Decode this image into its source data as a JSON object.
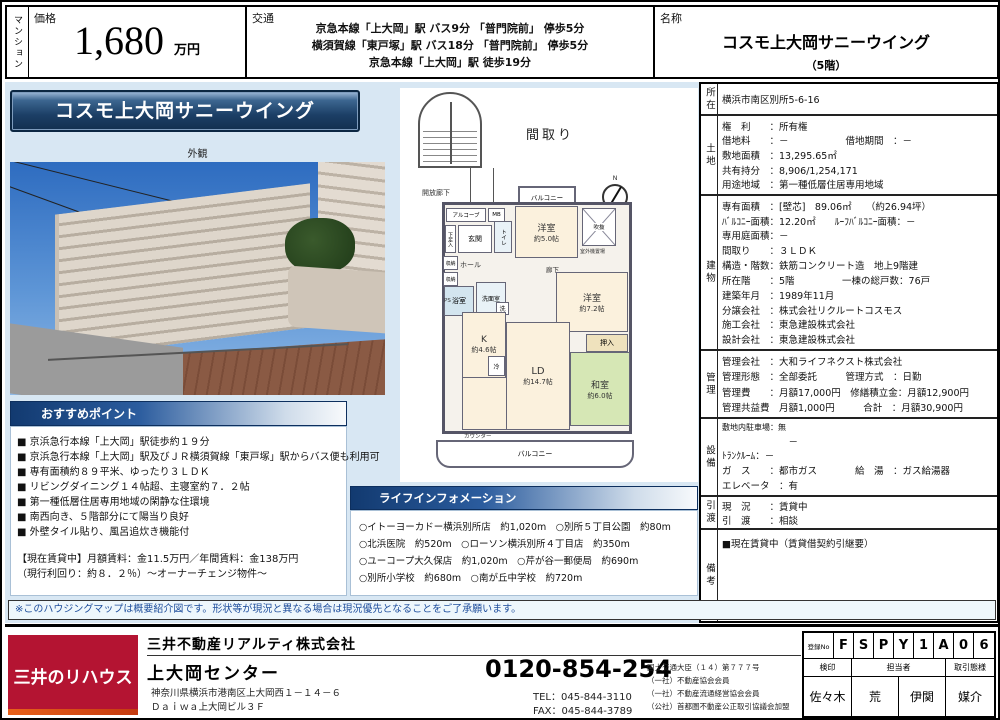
{
  "colors": {
    "accent_navy": "#16386b",
    "brand_red": "#b41432",
    "page_bg": "#d8e7f3"
  },
  "header": {
    "category": "マンション",
    "price_label": "価格",
    "price_value": "1,680",
    "price_unit": "万円",
    "access_label": "交通",
    "access_lines": [
      "京急本線「上大岡」駅 バス9分 「普門院前」 停歩5分",
      "横須賀線「東戸塚」駅 バス18分 「普門院前」 停歩5分",
      "京急本線「上大岡」駅 徒歩19分"
    ],
    "name_label": "名称",
    "name_value": "コスモ上大岡サニーウイング",
    "name_floor": "（5階）"
  },
  "left": {
    "banner": "コスモ上大岡サニーウイング",
    "photo_caption": "外観",
    "recommend": {
      "title": "おすすめポイント",
      "items": [
        "■ 京浜急行本線「上大岡」駅徒歩約１９分",
        "■ 京浜急行本線「上大岡」駅及びＪＲ横須賀線「東戸塚」駅からバス便も利用可",
        "■ 専有面積約８９平米、ゆったり３ＬＤＫ",
        "■ リビングダイニング１４帖超、主寝室約７．２帖",
        "■ 第一種低層住居専用地域の閑静な住環境",
        "■ 南西向き、５階部分にて陽当り良好",
        "■ 外壁タイル貼り、風呂追炊き機能付"
      ],
      "notes": [
        "【現在賃貸中】月額賃料：金11.5万円／年間賃料：金138万円",
        "（現行利回り：約８．２％）～オーナーチェンジ物件～"
      ]
    }
  },
  "floorplan": {
    "title": "間取り",
    "compass_n": "N",
    "labels": {
      "open_corridor": "開放廊下",
      "alcove": "アルコーブ",
      "mb": "MB",
      "entrance": "玄関",
      "shoe_box": "下足入",
      "storage": "収納",
      "hall": "ホール",
      "toilet": "トイレ",
      "bath": "浴室",
      "washroom": "洗面室",
      "laundry": "洗",
      "ps": "PS",
      "corridor": "廊下",
      "balcony": "バルコニー",
      "western1_name": "洋室",
      "western1_size": "約5.0帖",
      "void": "吹抜",
      "outdoor_unit": "室外機置場",
      "western2_name": "洋室",
      "western2_size": "約7.2帖",
      "closet": "押入",
      "kitchen_name": "K",
      "kitchen_size": "約4.6帖",
      "fridge": "冷",
      "ld_name": "LD",
      "ld_size": "約14.7帖",
      "japanese_name": "和室",
      "japanese_size": "約6.0帖",
      "counter": "カウンター"
    }
  },
  "life_info": {
    "title": "ライフインフォメーション",
    "lines": [
      "○イトーヨーカドー横浜別所店　約1,020m　○別所５丁目公園　約80m",
      "○北浜医院　約520m　○ローソン横浜別所４丁目店　約350m",
      "○ユーコープ大久保店　約1,020m　○芹が谷一郵便局　約690m",
      "○別所小学校　約680m　○南が丘中学校　約720m"
    ]
  },
  "details": {
    "location": {
      "label": "所在",
      "value": "横浜市南区別所5-6-16"
    },
    "land": {
      "label": "土地",
      "lines": [
        "権　利　　：所有権",
        "借地料　　：－　　　　　　借地期間　：－",
        "敷地面積　：13,295.65㎡",
        "共有持分　：8,906/1,254,171",
        "用途地域　：第一種低層住居専用地域"
      ]
    },
    "building": {
      "label": "建物",
      "lines": [
        "専有面積　：[壁芯]　89.06㎡　　（約26.94坪）",
        "ﾊﾞﾙｺﾆｰ面積：12.20㎡　　ﾙｰﾌﾊﾞﾙｺﾆｰ面積：－",
        "専用庭面積：－",
        "間取り　　：３ＬＤＫ",
        "構造・階数：鉄筋コンクリート造　地上9階建",
        "所在階　　：5階　　　　　一棟の総戸数：76戸",
        "建築年月　：1989年11月",
        "分譲会社　：株式会社リクルートコスモス",
        "施工会社　：東急建設株式会社",
        "設計会社　：東急建設株式会社"
      ]
    },
    "management": {
      "label": "管理",
      "lines": [
        "管理会社　：大和ライフネクスト株式会社",
        "管理形態　：全部委託　　　管理方式　：日勤",
        "管理費　　：月額17,000円　修繕積立金：月額12,900円",
        "管理共益費　月額1,000円　　　合計　：月額30,900円"
      ]
    },
    "facility": {
      "label": "設備",
      "lines": [
        "敷地内駐車場：無",
        "　　　　　　　－",
        "ﾄﾗﾝｸﾙｰﾑ：－",
        "ガ　ス　　：都市ガス　　　　給　湯　：ガス給湯器",
        "エレベータ　：有"
      ]
    },
    "delivery": {
      "label": "引渡",
      "lines": [
        "現　況　　：賃貸中",
        "引　渡　　：相談"
      ]
    },
    "remarks": {
      "label": "備考",
      "lines": [
        "■現在賃貸中（賃貸借契約引継要）"
      ]
    }
  },
  "disclaimer": "※このハウジングマップは概要紹介図です。形状等が現況と異なる場合は現況優先となることをご了承願います。",
  "footer": {
    "logo": "三井のリハウス",
    "company": "三井不動産リアルティ株式会社",
    "branch": "上大岡センター",
    "address1": "神奈川県横浜市港南区上大岡西１－１４－６",
    "address2": "Ｄａｉｗａ上大岡ビル３Ｆ",
    "freedial": "0120-854-254",
    "tel": "TEL：045-844-3110",
    "fax": "FAX：045-844-3789",
    "license_lines": [
      "国土交通大臣（１４）第７７７号",
      "（一社）不動産協会会員",
      "（一社）不動産流通経営協会会員",
      "（公社）首都圏不動産公正取引協議会加盟"
    ],
    "registration": {
      "label": "登録No",
      "chars": [
        "F",
        "S",
        "P",
        "Y",
        "1",
        "A",
        "0",
        "6"
      ]
    },
    "stamp_headers": {
      "inspection": "検印",
      "staff": "担当者",
      "type": "取引態様"
    },
    "stamps": {
      "inspection": "佐々木",
      "staff1": "荒",
      "staff2": "伊関",
      "type": "媒介"
    }
  }
}
